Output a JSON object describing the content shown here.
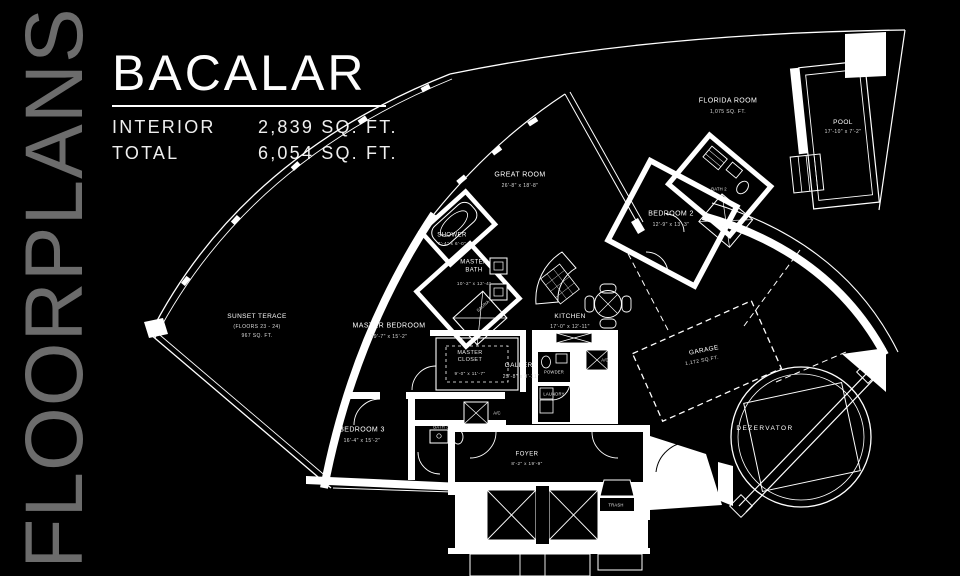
{
  "sidebar": {
    "vertical_title": "FLOORPLANS"
  },
  "header": {
    "title": "BACALAR",
    "specs": [
      {
        "label": "INTERIOR",
        "value": "2,839 SQ. FT."
      },
      {
        "label": "TOTAL",
        "value": "6,054 SQ. FT."
      }
    ]
  },
  "floorplan": {
    "colors": {
      "background": "#000000",
      "line": "#ffffff",
      "muted_text": "#6c6c6c"
    },
    "rooms": {
      "florida_room": {
        "name": "FLORIDA ROOM",
        "area": "1,075 SQ. FT."
      },
      "pool": {
        "name": "POOL",
        "dims": "17'-10\" x 7'-2\""
      },
      "great_room": {
        "name": "GREAT ROOM",
        "dims": "26'-8\" x 18'-8\""
      },
      "bedroom_2": {
        "name": "BEDROOM 2",
        "dims": "12'-9\" x 13'-3\""
      },
      "bath_2": {
        "name": "BATH 2"
      },
      "shower": {
        "name": "SHOWER",
        "dims": "7'-4\" x 6'-0\""
      },
      "master_bath": {
        "name": "MASTER BATH",
        "dims": "10'-2\" x 12'-4\""
      },
      "sauna": {
        "name": "SAUNA"
      },
      "sunset_terrace": {
        "name": "SUNSET TERACE",
        "floors": "(FLOORS 23 - 24)",
        "area": "967 SQ. FT."
      },
      "master_bedroom": {
        "name": "MASTER BEDROOM",
        "dims": "19'-7\" x 15'-2\""
      },
      "master_closet": {
        "name": "MASTER CLOSET",
        "dims": "9'-0\" x 11'-7\""
      },
      "kitchen": {
        "name": "KITCHEN",
        "dims": "17'-0\" x 12'-11\""
      },
      "gallery": {
        "name": "GALLERY",
        "dims": "25'-8\" x 9'-11\""
      },
      "powder": {
        "name": "POWDER"
      },
      "laundry": {
        "name": "LAUNDRY"
      },
      "ac_1": {
        "name": "A/C"
      },
      "ac_2": {
        "name": "A/C"
      },
      "garage": {
        "name": "GARAGE",
        "area": "1,172 SQ.FT."
      },
      "dezervator": {
        "name": "DEZERVATOR"
      },
      "bedroom_3": {
        "name": "BEDROOM 3",
        "dims": "16'-4\" x 15'-2\""
      },
      "bath_3": {
        "name": "BATH 3"
      },
      "foyer": {
        "name": "FOYER",
        "dims": "8'-2\" x 19'-9\""
      },
      "trash": {
        "name": "TRASH"
      }
    }
  }
}
